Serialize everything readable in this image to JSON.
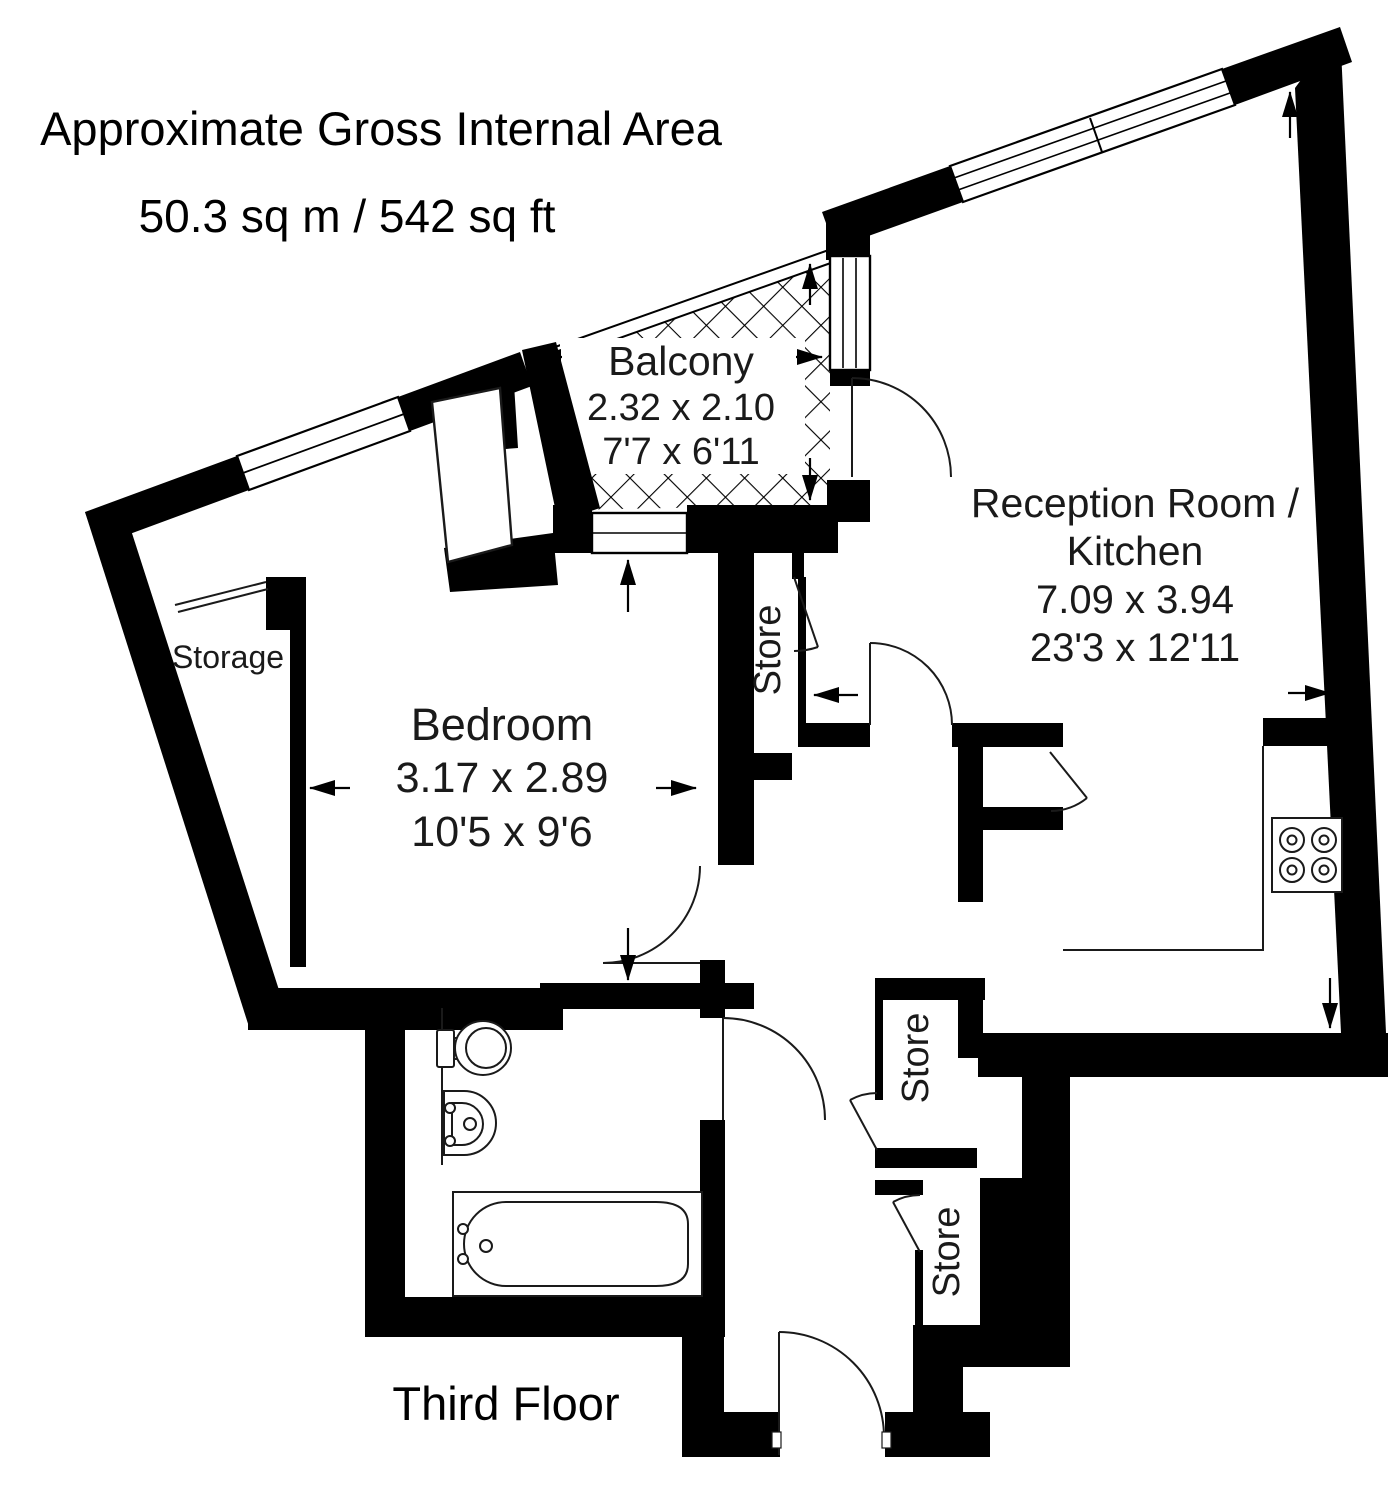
{
  "header": {
    "title": "Approximate Gross Internal Area",
    "area": "50.3 sq m / 542 sq ft"
  },
  "footer": {
    "floor_label": "Third Floor"
  },
  "rooms": {
    "balcony": {
      "name": "Balcony",
      "dimensions_metric": "2.32 x 2.10",
      "dimensions_imperial": "7'7 x 6'11"
    },
    "reception_kitchen": {
      "name_line1": "Reception Room /",
      "name_line2": "Kitchen",
      "dimensions_metric": "7.09 x 3.94",
      "dimensions_imperial": "23'3 x 12'11"
    },
    "bedroom": {
      "name": "Bedroom",
      "dimensions_metric": "3.17 x 2.89",
      "dimensions_imperial": "10'5 x 9'6"
    },
    "storage": {
      "name": "Storage"
    },
    "store_upper": {
      "name": "Store"
    },
    "store_middle": {
      "name": "Store"
    },
    "store_lower": {
      "name": "Store"
    }
  },
  "colors": {
    "wall": "#000000",
    "background": "#ffffff",
    "text": "#1a1a1a"
  }
}
